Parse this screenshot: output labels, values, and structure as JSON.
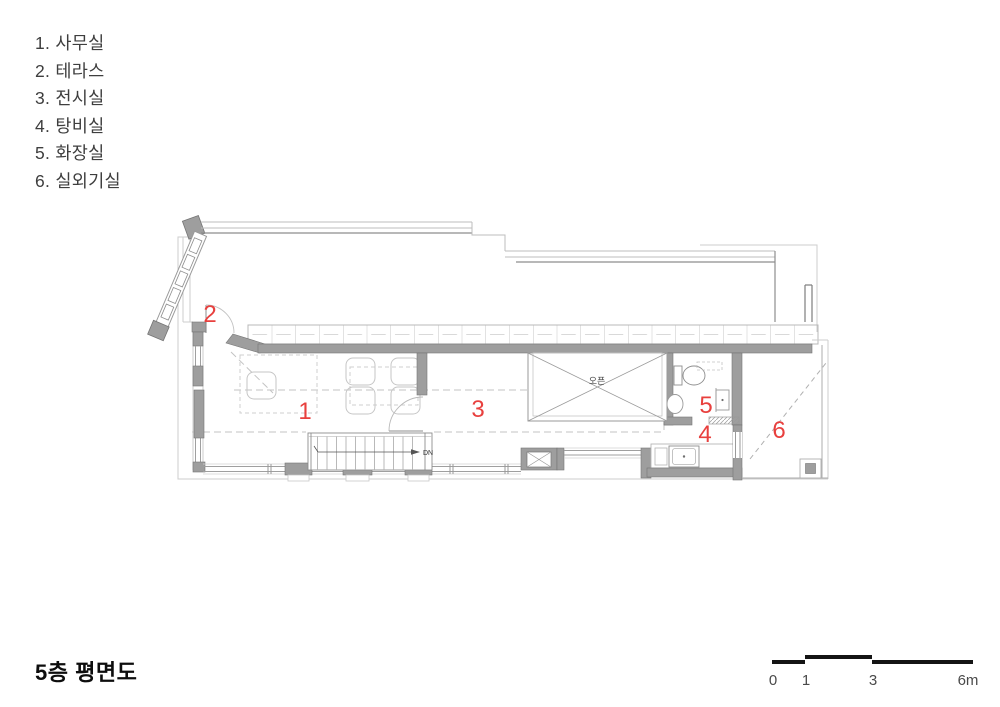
{
  "legend": {
    "items": [
      "1. 사무실",
      "2. 테라스",
      "3. 전시실",
      "4. 탕비실",
      "5. 화장실",
      "6. 실외기실"
    ]
  },
  "plan": {
    "room_labels": {
      "office": "1",
      "terrace": "2",
      "exhibition": "3",
      "pantry": "4",
      "toilet": "5",
      "outdoor_unit": "6"
    },
    "stair_direction_label": "DN",
    "void_label": "오픈"
  },
  "footer": {
    "title": "5층 평면도"
  },
  "scale_bar": {
    "labels": [
      "0",
      "1",
      "3",
      "6m"
    ]
  },
  "colors": {
    "label_red": "#e8403e"
  }
}
